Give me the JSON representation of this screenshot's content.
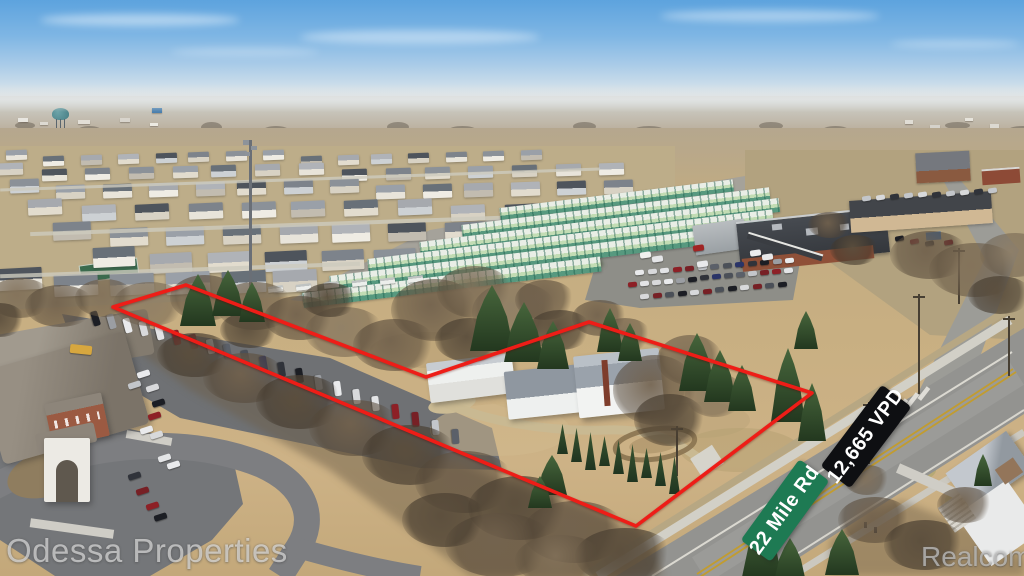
{
  "signs": {
    "street": {
      "label": "22 Mile Rd",
      "bg_color": "#1e7a53",
      "text_color": "#ffffff"
    },
    "traffic_count": {
      "label": "12,665 VPD",
      "bg_color": "#0e0f12",
      "text_color": "#ffffff"
    }
  },
  "watermarks": {
    "primary": "Odessa Properties",
    "secondary": "Realcomp"
  },
  "overlay": {
    "property_outline_color": "#ee1d17"
  }
}
